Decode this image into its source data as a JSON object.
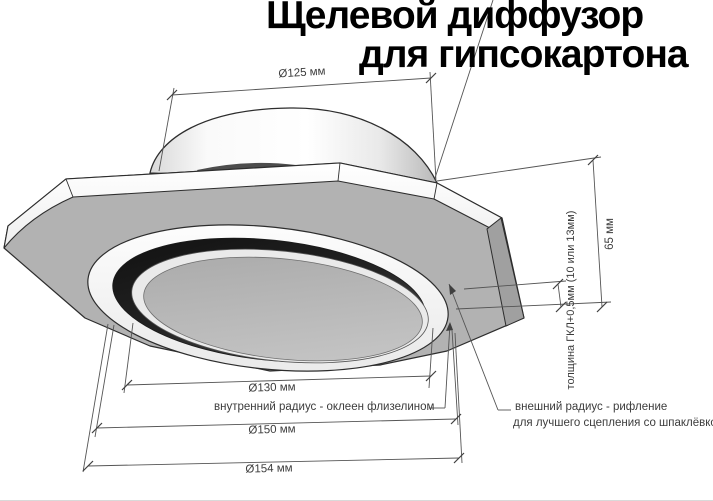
{
  "title": {
    "line1": "Щелевой диффузор",
    "line2": "для гипсокартона"
  },
  "dimensions": {
    "collar_diameter": "Ø125 мм",
    "height": "65 мм",
    "gkl_thickness": "толщина ГКЛ+0,5мм (10 или 13мм)",
    "inner_diameter": "Ø130 мм",
    "middle_diameter": "Ø150 мм",
    "outer_diameter": "Ø154 мм"
  },
  "callouts": {
    "inner_radius": "внутренний радиус - оклеен флизелином",
    "outer_radius_line1": "внешний радиус - рифление",
    "outer_radius_line2": "для лучшего сцепления со шпаклёвкой"
  },
  "colors": {
    "background": "#ffffff",
    "plate_underside": "#b2b2b2",
    "plate_edge_band": "#fafafa",
    "slot_dark": "#1e1e1e",
    "center_disc": "#b7b7b7",
    "outline": "#2d2d2d",
    "dimension_line": "#555555",
    "text": "#3c3c3c",
    "title_text": "#000000"
  }
}
